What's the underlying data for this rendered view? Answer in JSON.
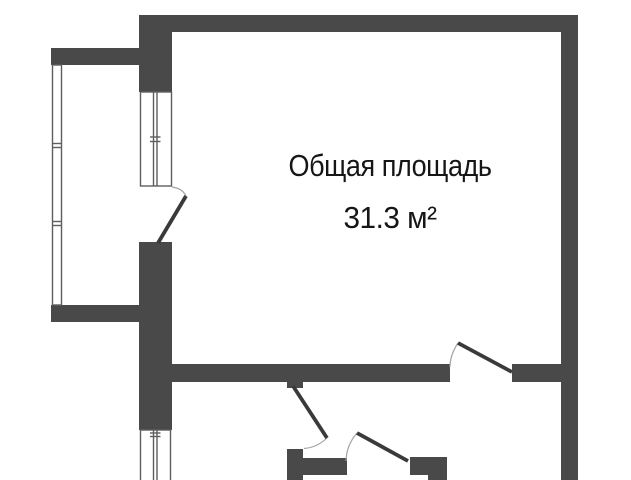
{
  "floor_plan": {
    "type": "apartment-floor-plan",
    "room_label": "Общая площадь",
    "room_area": "31.3 м²",
    "colors": {
      "background": "#ffffff",
      "wall": "#494949",
      "window_line": "#5e5e5e",
      "door_leaf": "#3a3a3a",
      "door_arc": "#a3a3a3",
      "text": "#161616"
    }
  }
}
